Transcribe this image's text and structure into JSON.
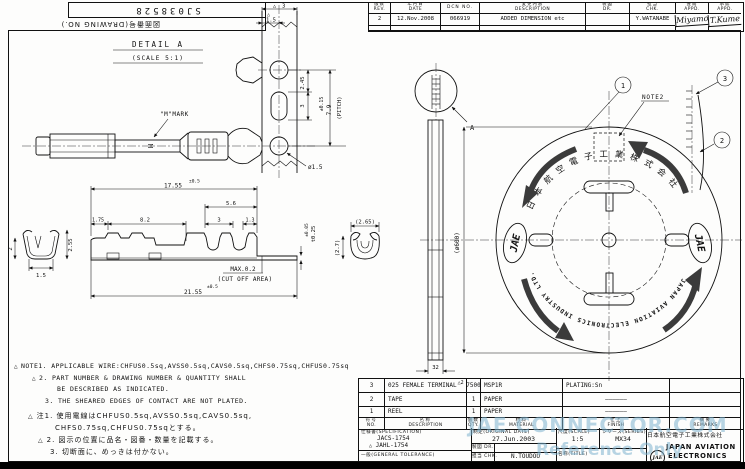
{
  "corner": {
    "drawing_no": "SJ038528",
    "drawing_no_label": "図面番号(DRAWING NO.)"
  },
  "revision_table": {
    "headers": {
      "rev_jp": "版数",
      "rev_en": "REV.",
      "date_jp": "年月日",
      "date_en": "DATE",
      "dcn": "DCN NO.",
      "desc_jp": "変更内容",
      "desc_en": "DESCRIPTION",
      "dr_jp": "製図",
      "dr_en": "DR.",
      "chk_jp": "担当",
      "chk_en": "CHK.",
      "appd1_jp": "査閲",
      "appd1_en": "APPD.",
      "appd2_jp": "承認",
      "appd2_en": "APPD."
    },
    "row": {
      "rev": "2",
      "date": "12.Nov.2008",
      "dcn_no": "066919",
      "description": "ADDED DIMENSION etc",
      "dr": "",
      "chk": "Y.WATANABE",
      "appd1": "K.Miyamoto",
      "appd2": "T.Kume"
    }
  },
  "detail_a": {
    "title": "DETAIL A",
    "scale": "(SCALE 5:1)",
    "m_mark": "\"M\"MARK",
    "dims": {
      "rev_triangle": "△",
      "strip_width": "3",
      "hole_offset": "1.5",
      "hole_to_slot": "2.45",
      "slot_len": "3",
      "pitch_tol": "±0.15",
      "pitch": "7.9",
      "pitch_label": "(PITCH)",
      "hole_dia": "ø1.5"
    }
  },
  "side_view": {
    "dims": {
      "len_total": "17.55",
      "len_total_tol": "±0.5",
      "len_56": "5.6",
      "len_175": "1.75",
      "len_82": "8.2",
      "len_3": "3",
      "len_13": "1.3",
      "overall": "21.55",
      "overall_tol": "±0.5",
      "cutoff_max": "MAX.0.2",
      "cutoff_area": "(CUT OFF AREA)",
      "thickness": "t0.25",
      "thickness_tol": "±0.05",
      "front_h1": "2",
      "front_h2": "2.55",
      "front_w": "1.5",
      "cs_w": "(2.65)",
      "cs_h": "(2.7)"
    }
  },
  "reel": {
    "balloon_1": "1",
    "balloon_2": "2",
    "balloon_3": "3",
    "note2": "NOTE2",
    "detail_label": "A",
    "dia": "(ø600)",
    "width": "32",
    "company_arc_jp": "日本航空電子工業株式会社",
    "company_arc_en": "JAPAN AVIATION ELECTRONICS INDUSTRY LTD.",
    "logo": "JAE"
  },
  "notes": {
    "en": [
      {
        "marker": "△",
        "text": "NOTE1. APPLICABLE WIRE:CHFUS0.5sq,AVSS0.5sq,CAVS0.5sq,CHFS0.75sq,CHFUS0.75sq"
      },
      {
        "marker": "△",
        "text": "2. PART NUMBER & DRAWING NUMBER & QUANTITY SHALL"
      },
      {
        "marker": "",
        "text": "BE DESCRIBED AS INDICATED."
      },
      {
        "marker": "",
        "text": "3. THE SHEARED EDGES OF CONTACT ARE NOT PLATED."
      }
    ],
    "jp": [
      {
        "marker": "△",
        "text": "注1. 使用電線はCHFUS0.5sq,AVSS0.5sq,CAVS0.5sq,"
      },
      {
        "marker": "",
        "text": "CHFS0.75sq,CHFUS0.75sqとする。"
      },
      {
        "marker": "△",
        "text": "2. 図示の位置に品名・図番・数量を記載する。"
      },
      {
        "marker": "",
        "text": "3. 切断面に、めっきは付かない。"
      }
    ]
  },
  "title_block": {
    "parts": [
      {
        "no": "3",
        "description": "025 FEMALE TERMINAL",
        "mark": "△2",
        "qty": "7500",
        "material": "MSP1R",
        "finish": "PLATING:Sn",
        "remarks": ""
      },
      {
        "no": "2",
        "description": "TAPE",
        "mark": "",
        "qty": "1",
        "material": "PAPER",
        "finish": "――――――",
        "remarks": ""
      },
      {
        "no": "1",
        "description": "REEL",
        "mark": "",
        "qty": "1",
        "material": "PAPER",
        "finish": "――――――",
        "remarks": ""
      }
    ],
    "header": {
      "no_jp": "符号",
      "no_en": "NO.",
      "desc_jp": "名称",
      "desc_en": "DESCRIPTION",
      "qty_jp": "個数",
      "qty_en": "QTY.",
      "mat_jp": "材料",
      "mat_en": "MATERIAL",
      "finish_jp": "仕上",
      "finish_en": "FINISH",
      "remarks_jp": "摘要",
      "remarks_en": "REMARKS"
    },
    "spec_label": "仕様書(SPECIFICATION)",
    "spec_1": "JACS-1754",
    "spec_2_mark": "△",
    "spec_2": "JAHL-1754",
    "tolerance_label": "一般(GENERAL TOLERANCE)",
    "date_label": "制定(ORIGINAL DATE)",
    "date_value": "27.Jun.2003",
    "dr_label_jp": "製図",
    "dr_label_en": "DR.",
    "dr_value": "",
    "chk_label_jp": "担当",
    "chk_label_en": "CHK.",
    "chk_value": "N.TOUDOU",
    "scale_label": "尺度(SCALE)",
    "scale_value": "1:5",
    "series_label": "シリーズ(SERIES)",
    "series_value": "MX34",
    "title_label": "名称(TITLE)",
    "company_jp": "日本航空電子工業株式会社",
    "company_en_1": "JAPAN AVIATION",
    "company_en_2": "ELECTRONICS",
    "logo": "JAE"
  },
  "watermark": {
    "line1": "JAE CONNECTOR.COM",
    "line2": "Reference Only",
    "color": "#7db2cd"
  }
}
